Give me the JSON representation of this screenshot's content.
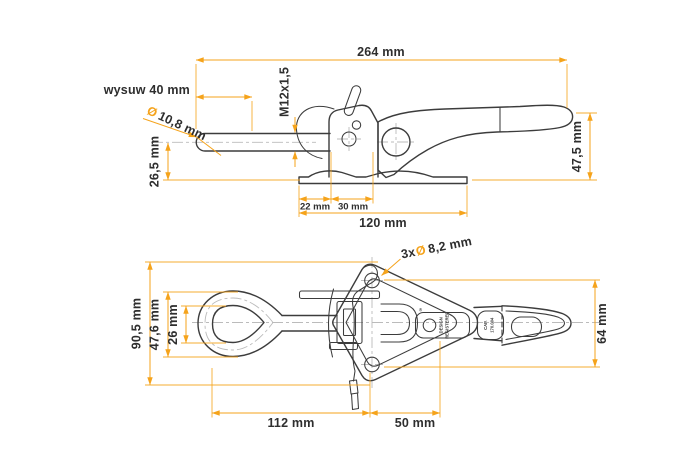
{
  "colors": {
    "accent": "#F5A31B",
    "drawing_ink": "#3C3C3C",
    "centerline": "#BBBBBB",
    "label_text": "#2E2E2E",
    "background": "#FFFFFF"
  },
  "side_view": {
    "overall_length": "264 mm",
    "extension_label": "wysuw 40 mm",
    "rod_diameter_symbol": "Ø",
    "rod_diameter_value": "10,8 mm",
    "axis_height": "26,5 mm",
    "thread_spec": "M12x1,5",
    "overall_height": "47,5 mm",
    "hole_offset": "22 mm",
    "hole_pitch": "30 mm",
    "base_plate_length": "120 mm"
  },
  "plan_view": {
    "holes_count_prefix": "3x",
    "holes_diameter_symbol": "Ø",
    "holes_diameter_value": "8,2 mm",
    "overall_width": "90,5 mm",
    "loop_outer_width": "47,6 mm",
    "loop_inner_width": "26 mm",
    "handle_width": "64 mm",
    "loop_to_holes_length": "112 mm",
    "holes_pitch": "50 mm",
    "stamp_registered_symbol": "®",
    "stamp_design_line1": "DESIGN",
    "stamp_design_line2": "REGISTERED",
    "stamp_cap_line1": "CAP.",
    "stamp_cap_line2": "170.004"
  }
}
